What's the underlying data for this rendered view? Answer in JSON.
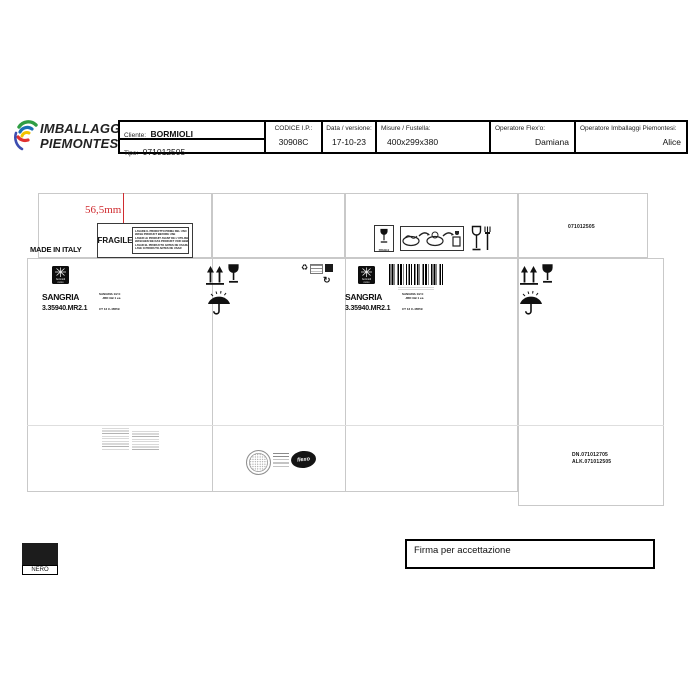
{
  "colors": {
    "accent_red": "#d02c30",
    "die_line_gray": "#c9c9c9",
    "ink_black": "#111111",
    "logo_green": "#2f9e44",
    "logo_blue": "#1c6fb5",
    "logo_yellow": "#f2c200",
    "logo_red": "#e03131"
  },
  "header": {
    "logo": {
      "line1": "IMBALLAGGI",
      "line2": "PIEMONTESI"
    },
    "table": {
      "cliente_label": "Cliente:",
      "cliente_value": "BORMIOLI",
      "tipo_label": "Tipo:",
      "tipo_value": "071012505",
      "codice_label": "CODICE I.P.:",
      "codice_value": "30908C",
      "data_label": "Data / versione:",
      "data_value": "17-10-23",
      "misure_label": "Misure / Fustella:",
      "misure_value": "400x299x380",
      "flexo_label": "Operatore Flex'o:",
      "flexo_value": "Damiana",
      "imballaggi_label": "Operatore Imballaggi Piemontesi:",
      "imballaggi_value": "Alice"
    }
  },
  "drawing": {
    "dimension_label": "56,5mm",
    "made_in_italy": "MADE IN ITALY",
    "fragile_label": "FRAGILE",
    "care_lines": [
      "LAVARE IL PRODOTTO PRIMA DEL USO",
      "WASH PRODUCT BEFORE USE",
      "LAVER LE PRODUIT AVANT DE L'UTILISER",
      "WASCHEN SIE DAS PRODUKT VOR GEBRAUCH",
      "LAVAR EL PRODUCTO ANTES DE USARLO",
      "LAVE O PRODUTO ANTES DE USAR"
    ],
    "fragile_icon_caption": "FRAGILE",
    "top_right_code": "071012505",
    "brand_logo": {
      "line1": "bormioli",
      "line2": "rocco"
    },
    "product": {
      "name": "SANGRIA",
      "code": "3.35940.MR2.1",
      "detail_line1": "SANGRIA 1/2 lt",
      "detail_line2": "JRD GB 1 ea",
      "detail_line3": "CT 12 C-46559"
    },
    "bottom_codes": {
      "line1": "DN.071012705",
      "line2": "ALK.071012505"
    },
    "printer_logo": "flexo"
  },
  "footer": {
    "color_swatch_label": "NERO",
    "signature_label": "Firma per accettazione"
  },
  "icons": {
    "recycle_glyph": "♻",
    "rotate_glyph": "↻"
  }
}
